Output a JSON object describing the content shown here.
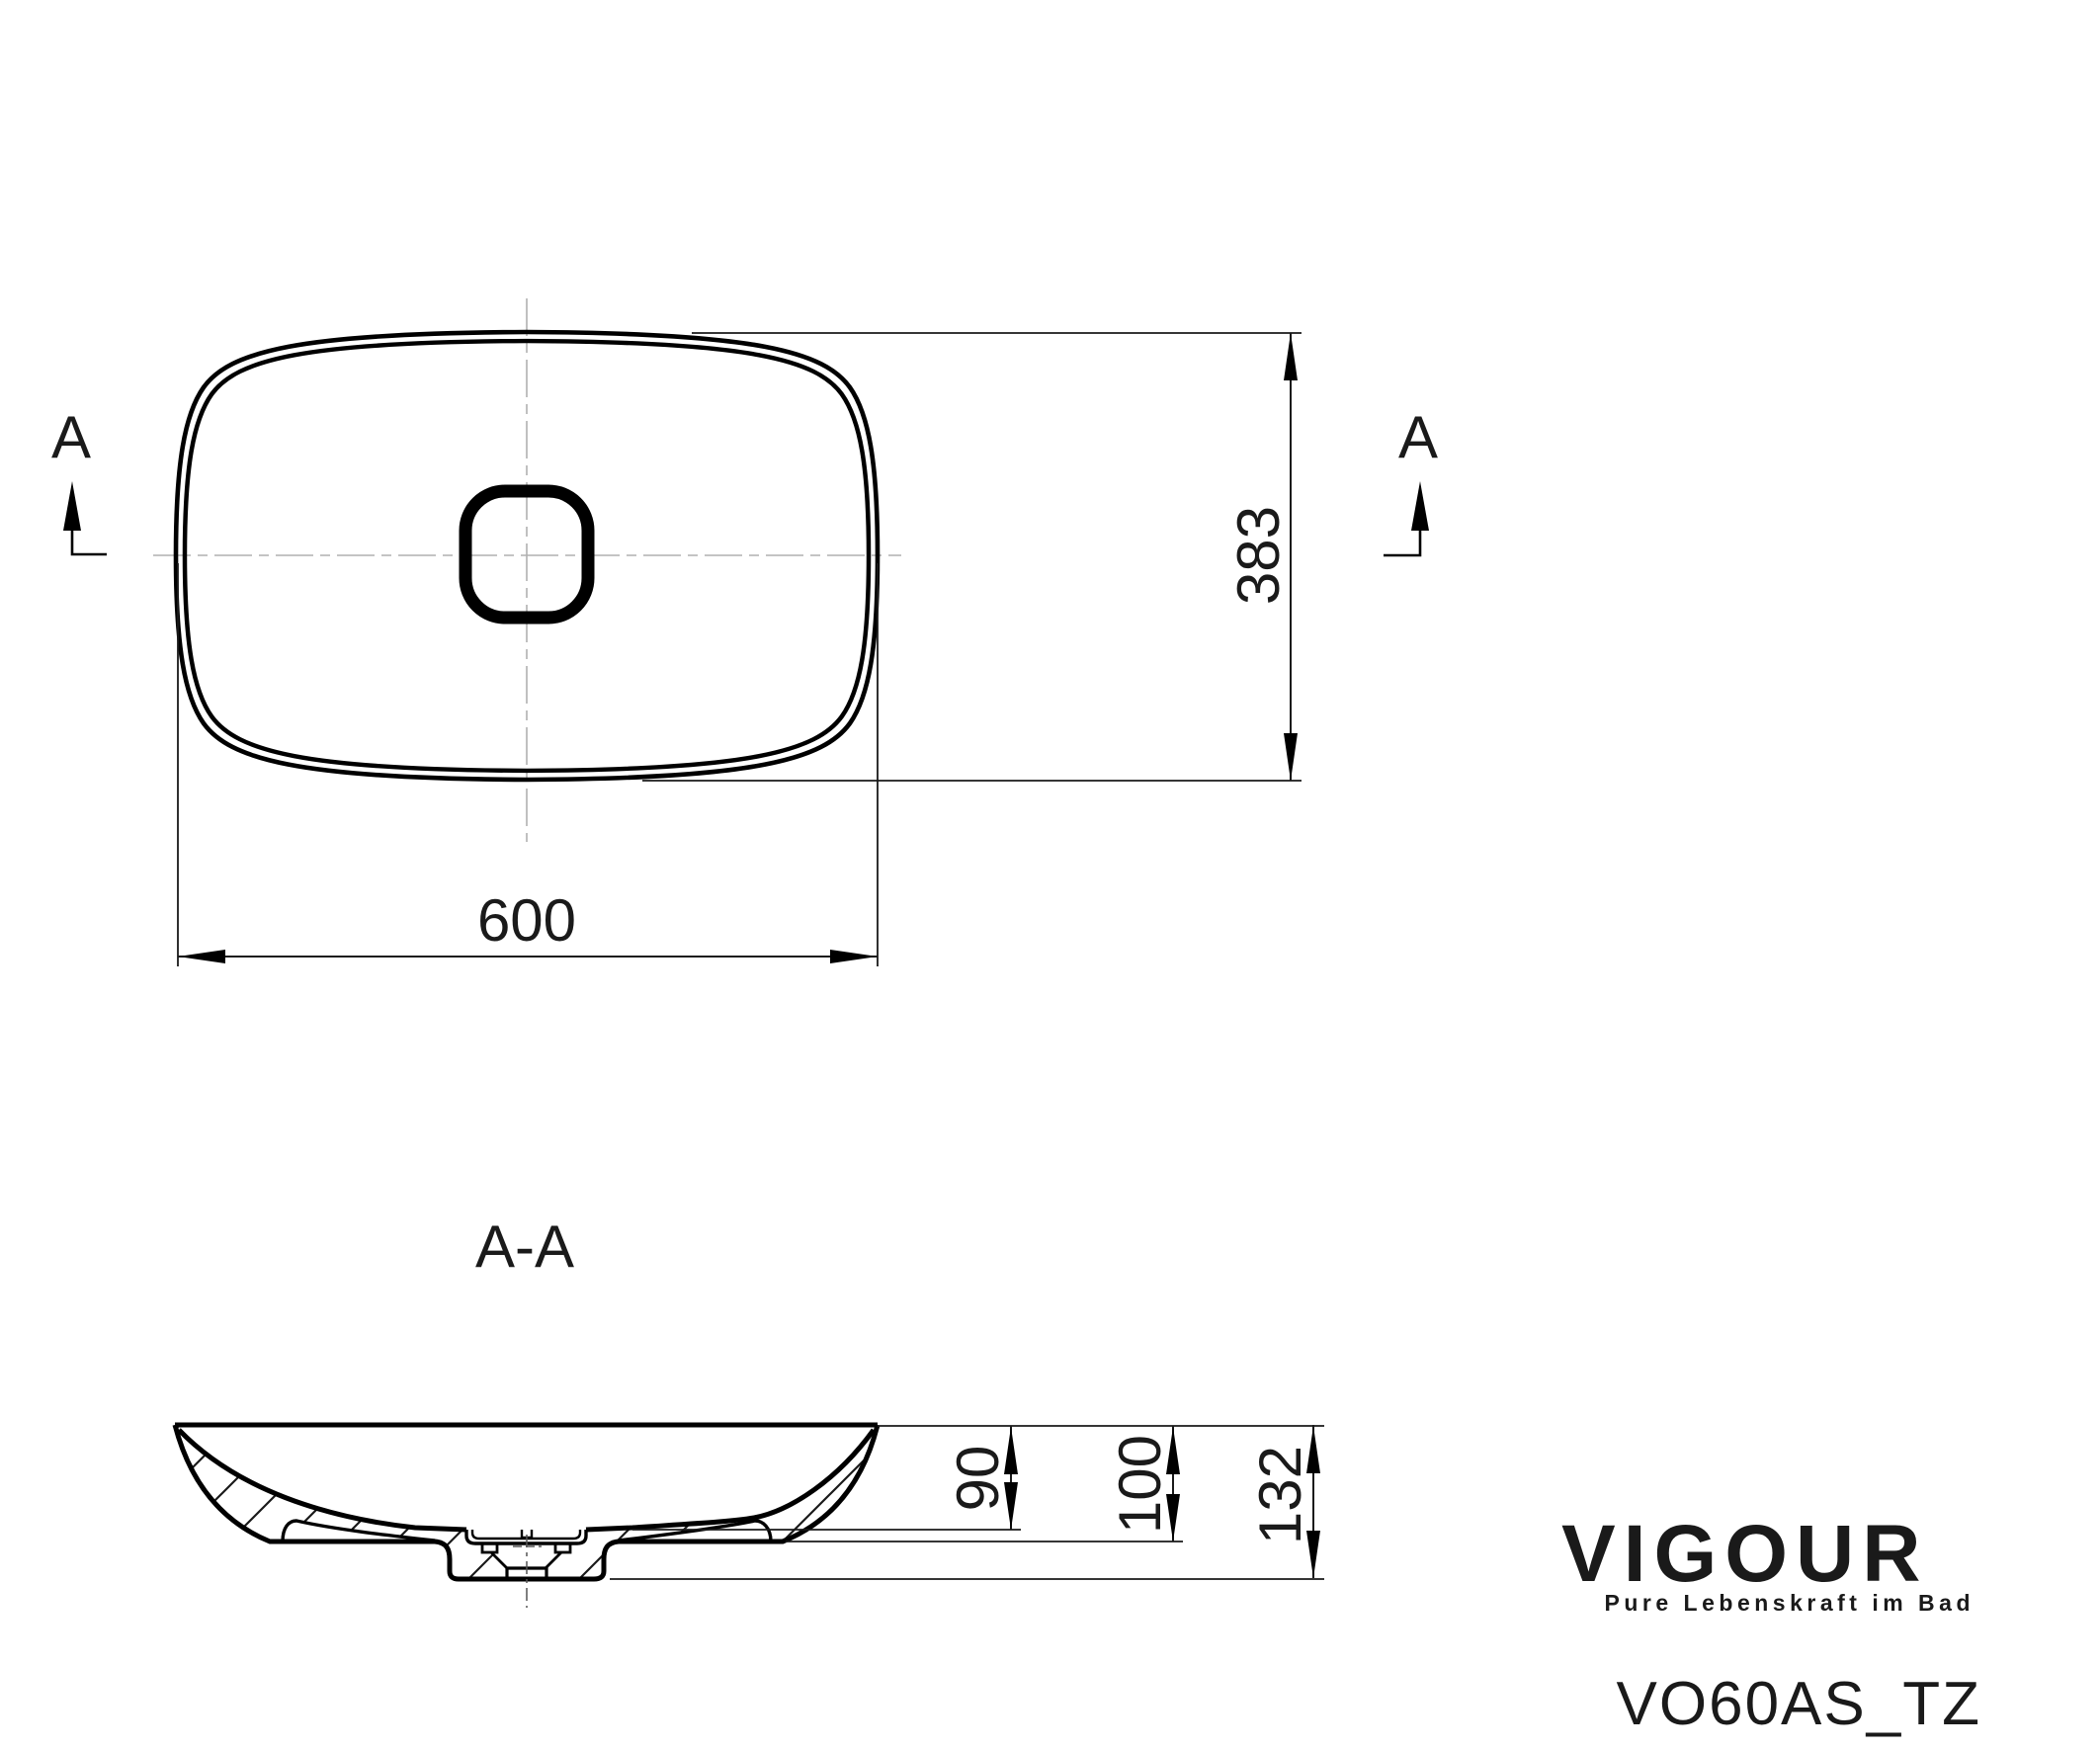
{
  "drawing": {
    "type": "technical-drawing",
    "line_color": "#000000",
    "centerline_color": "#b0b0b0"
  },
  "top_view": {
    "section_label_left": "A",
    "section_label_right": "A",
    "dim_width": "600",
    "dim_depth": "383"
  },
  "section_view": {
    "title": "A-A",
    "dim_bowl_depth": "90",
    "dim_underside_height": "100",
    "dim_total_height": "132"
  },
  "branding": {
    "logo_text": "VIGOUR",
    "logo_color": "#1b7b8e",
    "tagline": "Pure Lebenskraft im Bad",
    "tagline_color": "#f0a055"
  },
  "product_code": "VO60AS_TZ"
}
